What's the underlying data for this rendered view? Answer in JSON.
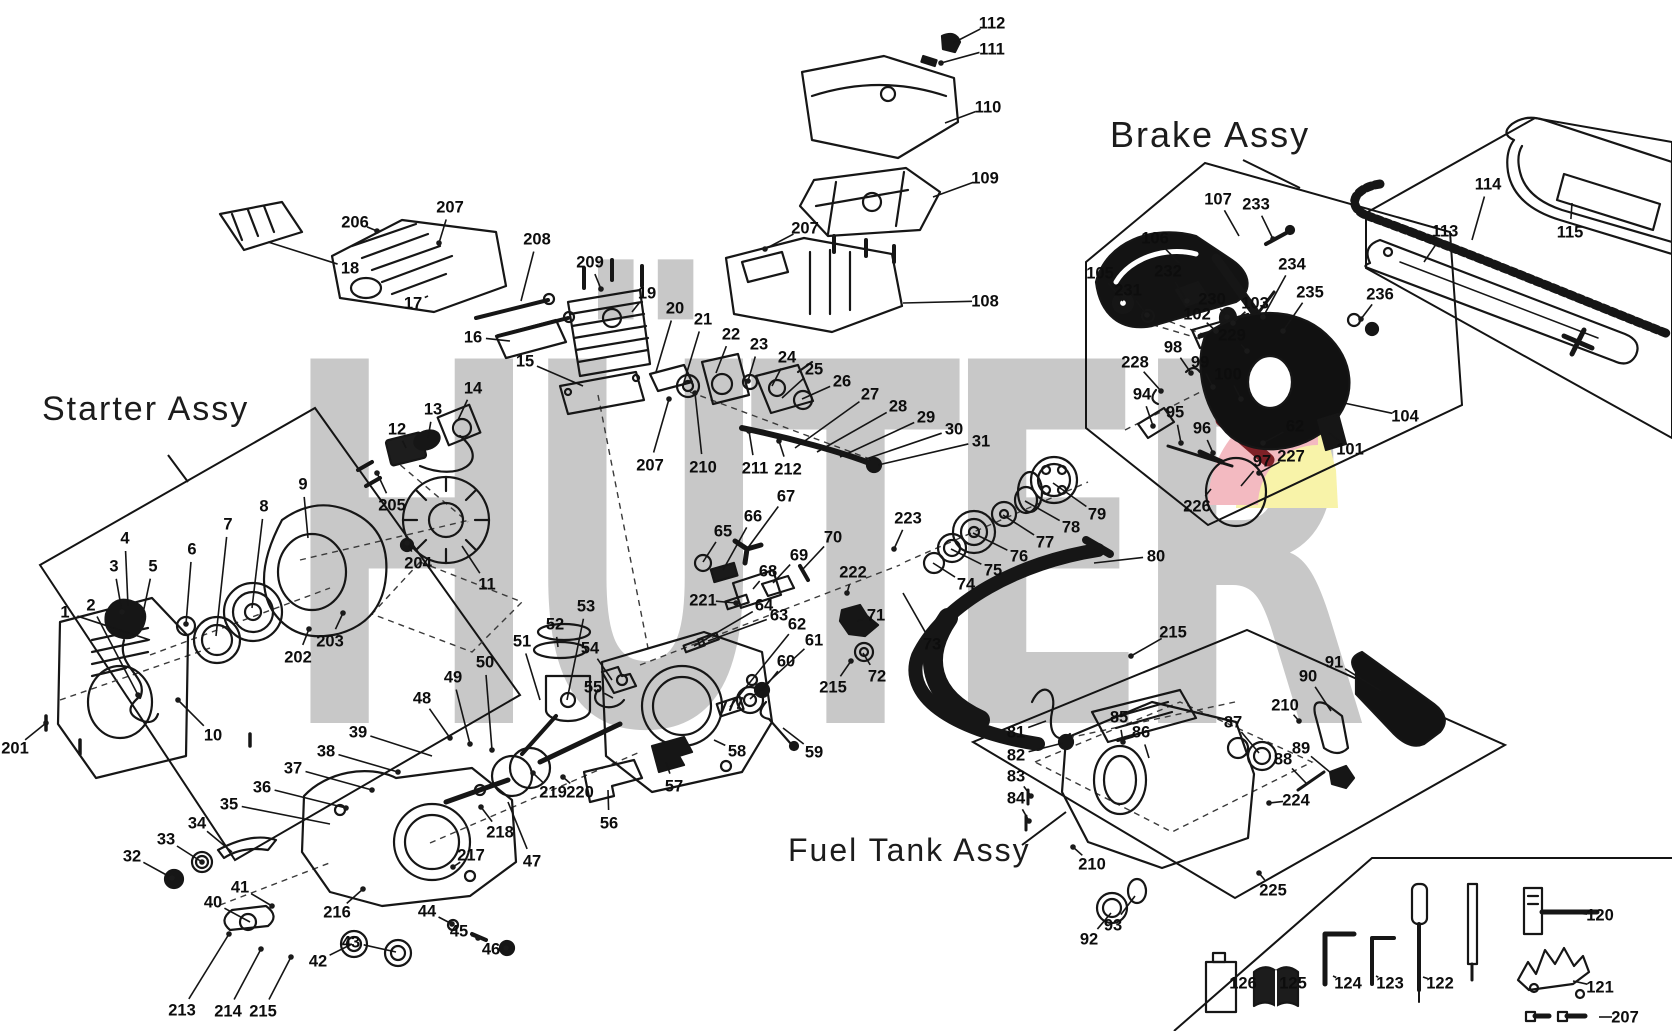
{
  "watermark": {
    "text": "HÜTER",
    "color": "#c8c8c8",
    "accent_pink": "#f3bac1",
    "accent_red": "#7e2127",
    "accent_yellow": "#f8f3a9"
  },
  "assembly_labels": [
    {
      "text": "Starter Assy",
      "x": 42,
      "y": 390,
      "fs": 34
    },
    {
      "text": "Brake Assy",
      "x": 1110,
      "y": 114,
      "fs": 36
    },
    {
      "text": "Fuel Tank Assy",
      "x": 788,
      "y": 832,
      "fs": 32
    }
  ],
  "parts": [
    {
      "n": "1",
      "x": 65,
      "y": 612,
      "tx": 150,
      "ty": 640
    },
    {
      "n": "2",
      "x": 91,
      "y": 605,
      "tx": 138,
      "ty": 695,
      "d": 1
    },
    {
      "n": "3",
      "x": 114,
      "y": 566,
      "tx": 122,
      "ty": 612,
      "d": 1
    },
    {
      "n": "4",
      "x": 125,
      "y": 538,
      "tx": 128,
      "ty": 606
    },
    {
      "n": "5",
      "x": 153,
      "y": 566,
      "tx": 142,
      "ty": 618
    },
    {
      "n": "6",
      "x": 192,
      "y": 549,
      "tx": 186,
      "ty": 624,
      "d": 1
    },
    {
      "n": "7",
      "x": 228,
      "y": 524,
      "tx": 216,
      "ty": 636
    },
    {
      "n": "8",
      "x": 264,
      "y": 506,
      "tx": 252,
      "ty": 608
    },
    {
      "n": "9",
      "x": 303,
      "y": 484,
      "tx": 308,
      "ty": 538
    },
    {
      "n": "10",
      "x": 213,
      "y": 735,
      "tx": 178,
      "ty": 700,
      "d": 1
    },
    {
      "n": "11",
      "x": 487,
      "y": 584,
      "tx": 462,
      "ty": 546
    },
    {
      "n": "12",
      "x": 397,
      "y": 429,
      "tx": 406,
      "ty": 448
    },
    {
      "n": "13",
      "x": 433,
      "y": 409,
      "tx": 428,
      "ty": 438
    },
    {
      "n": "14",
      "x": 473,
      "y": 388,
      "tx": 458,
      "ty": 420
    },
    {
      "n": "15",
      "x": 525,
      "y": 361,
      "tx": 583,
      "ty": 386
    },
    {
      "n": "16",
      "x": 473,
      "y": 337,
      "tx": 510,
      "ty": 341
    },
    {
      "n": "17",
      "x": 413,
      "y": 303,
      "tx": 428,
      "ty": 296
    },
    {
      "n": "18",
      "x": 350,
      "y": 268,
      "tx": 268,
      "ty": 242
    },
    {
      "n": "19",
      "x": 647,
      "y": 293,
      "tx": 632,
      "ty": 312
    },
    {
      "n": "20",
      "x": 675,
      "y": 308,
      "tx": 656,
      "ty": 372
    },
    {
      "n": "21",
      "x": 703,
      "y": 319,
      "tx": 684,
      "ty": 382
    },
    {
      "n": "22",
      "x": 731,
      "y": 334,
      "tx": 716,
      "ty": 373
    },
    {
      "n": "23",
      "x": 759,
      "y": 344,
      "tx": 748,
      "ty": 381,
      "d": 1
    },
    {
      "n": "24",
      "x": 787,
      "y": 357,
      "tx": 772,
      "ty": 386
    },
    {
      "n": "25",
      "x": 814,
      "y": 369,
      "tx": 782,
      "ty": 398
    },
    {
      "n": "26",
      "x": 842,
      "y": 381,
      "tx": 802,
      "ty": 399
    },
    {
      "n": "27",
      "x": 870,
      "y": 394,
      "tx": 795,
      "ty": 448
    },
    {
      "n": "28",
      "x": 898,
      "y": 406,
      "tx": 817,
      "ty": 452
    },
    {
      "n": "29",
      "x": 926,
      "y": 417,
      "tx": 840,
      "ty": 457
    },
    {
      "n": "30",
      "x": 954,
      "y": 429,
      "tx": 860,
      "ty": 461
    },
    {
      "n": "31",
      "x": 981,
      "y": 441,
      "tx": 878,
      "ty": 465
    },
    {
      "n": "32",
      "x": 132,
      "y": 856,
      "tx": 172,
      "ty": 878,
      "d": 1
    },
    {
      "n": "33",
      "x": 166,
      "y": 839,
      "tx": 202,
      "ty": 862,
      "d": 1
    },
    {
      "n": "34",
      "x": 197,
      "y": 823,
      "tx": 232,
      "ty": 852
    },
    {
      "n": "35",
      "x": 229,
      "y": 804,
      "tx": 330,
      "ty": 824
    },
    {
      "n": "36",
      "x": 262,
      "y": 787,
      "tx": 346,
      "ty": 808,
      "d": 1
    },
    {
      "n": "37",
      "x": 293,
      "y": 768,
      "tx": 372,
      "ty": 790,
      "d": 1
    },
    {
      "n": "38",
      "x": 326,
      "y": 751,
      "tx": 398,
      "ty": 772,
      "d": 1
    },
    {
      "n": "39",
      "x": 358,
      "y": 732,
      "tx": 432,
      "ty": 756
    },
    {
      "n": "40",
      "x": 213,
      "y": 902,
      "tx": 250,
      "ty": 922
    },
    {
      "n": "41",
      "x": 240,
      "y": 887,
      "tx": 272,
      "ty": 906,
      "d": 1
    },
    {
      "n": "42",
      "x": 318,
      "y": 961,
      "tx": 352,
      "ty": 944
    },
    {
      "n": "43",
      "x": 351,
      "y": 942,
      "tx": 396,
      "ty": 952
    },
    {
      "n": "44",
      "x": 427,
      "y": 911,
      "tx": 452,
      "ty": 924,
      "d": 1
    },
    {
      "n": "45",
      "x": 459,
      "y": 931,
      "tx": 478,
      "ty": 938,
      "d": 1
    },
    {
      "n": "46",
      "x": 491,
      "y": 949,
      "tx": 506,
      "ty": 948,
      "d": 1
    },
    {
      "n": "47",
      "x": 532,
      "y": 861,
      "tx": 508,
      "ty": 802
    },
    {
      "n": "48",
      "x": 422,
      "y": 698,
      "tx": 450,
      "ty": 738,
      "d": 1
    },
    {
      "n": "49",
      "x": 453,
      "y": 677,
      "tx": 470,
      "ty": 744,
      "d": 1
    },
    {
      "n": "50",
      "x": 485,
      "y": 662,
      "tx": 492,
      "ty": 750,
      "d": 1
    },
    {
      "n": "51",
      "x": 522,
      "y": 641,
      "tx": 540,
      "ty": 700
    },
    {
      "n": "52",
      "x": 555,
      "y": 624,
      "tx": 558,
      "ty": 647
    },
    {
      "n": "53",
      "x": 586,
      "y": 606,
      "tx": 567,
      "ty": 700
    },
    {
      "n": "54",
      "x": 590,
      "y": 648,
      "tx": 612,
      "ty": 680
    },
    {
      "n": "55",
      "x": 593,
      "y": 687,
      "tx": 613,
      "ty": 698
    },
    {
      "n": "56",
      "x": 609,
      "y": 823,
      "tx": 608,
      "ty": 790
    },
    {
      "n": "57",
      "x": 674,
      "y": 786,
      "tx": 666,
      "ty": 762
    },
    {
      "n": "58",
      "x": 737,
      "y": 751,
      "tx": 714,
      "ty": 740
    },
    {
      "n": "59",
      "x": 814,
      "y": 752,
      "tx": 783,
      "ty": 728
    },
    {
      "n": "60",
      "x": 786,
      "y": 661,
      "tx": 762,
      "ty": 691
    },
    {
      "n": "61",
      "x": 814,
      "y": 640,
      "tx": 750,
      "ty": 699
    },
    {
      "n": "62",
      "x": 797,
      "y": 624,
      "tx": 730,
      "ty": 707
    },
    {
      "n": "63",
      "x": 779,
      "y": 615,
      "tx": 708,
      "ty": 641
    },
    {
      "n": "64",
      "x": 764,
      "y": 605,
      "tx": 694,
      "ty": 646
    },
    {
      "n": "65",
      "x": 723,
      "y": 531,
      "tx": 703,
      "ty": 562
    },
    {
      "n": "66",
      "x": 753,
      "y": 516,
      "tx": 723,
      "ty": 570
    },
    {
      "n": "67",
      "x": 786,
      "y": 496,
      "tx": 747,
      "ty": 549
    },
    {
      "n": "68",
      "x": 768,
      "y": 571,
      "tx": 753,
      "ty": 589
    },
    {
      "n": "69",
      "x": 799,
      "y": 555,
      "tx": 773,
      "ty": 583
    },
    {
      "n": "70",
      "x": 833,
      "y": 537,
      "tx": 803,
      "ty": 569
    },
    {
      "n": "71",
      "x": 876,
      "y": 615,
      "tx": 857,
      "ty": 621
    },
    {
      "n": "72",
      "x": 877,
      "y": 676,
      "tx": 863,
      "ty": 653
    },
    {
      "n": "73",
      "x": 932,
      "y": 644,
      "tx": 903,
      "ty": 593
    },
    {
      "n": "74",
      "x": 966,
      "y": 584,
      "tx": 933,
      "ty": 563
    },
    {
      "n": "75",
      "x": 993,
      "y": 570,
      "tx": 951,
      "ty": 549
    },
    {
      "n": "76",
      "x": 1019,
      "y": 556,
      "tx": 973,
      "ty": 533
    },
    {
      "n": "77",
      "x": 1045,
      "y": 542,
      "tx": 1003,
      "ty": 515
    },
    {
      "n": "78",
      "x": 1071,
      "y": 527,
      "tx": 1025,
      "ty": 501
    },
    {
      "n": "79",
      "x": 1097,
      "y": 514,
      "tx": 1053,
      "ty": 483
    },
    {
      "n": "80",
      "x": 1156,
      "y": 556,
      "tx": 1094,
      "ty": 563
    },
    {
      "n": "81",
      "x": 1016,
      "y": 732,
      "tx": 1046,
      "ty": 721
    },
    {
      "n": "82",
      "x": 1016,
      "y": 755,
      "tx": 1063,
      "ty": 743
    },
    {
      "n": "83",
      "x": 1016,
      "y": 776,
      "tx": 1031,
      "ty": 796,
      "d": 1
    },
    {
      "n": "84",
      "x": 1016,
      "y": 798,
      "tx": 1029,
      "ty": 821,
      "d": 1
    },
    {
      "n": "85",
      "x": 1119,
      "y": 717,
      "tx": 1123,
      "ty": 742,
      "d": 1
    },
    {
      "n": "86",
      "x": 1141,
      "y": 732,
      "tx": 1149,
      "ty": 758
    },
    {
      "n": "87",
      "x": 1233,
      "y": 722,
      "tx": 1259,
      "ty": 753
    },
    {
      "n": "88",
      "x": 1283,
      "y": 759,
      "tx": 1306,
      "ty": 783
    },
    {
      "n": "89",
      "x": 1301,
      "y": 748,
      "tx": 1331,
      "ty": 773
    },
    {
      "n": "90",
      "x": 1308,
      "y": 676,
      "tx": 1331,
      "ty": 711
    },
    {
      "n": "91",
      "x": 1334,
      "y": 662,
      "tx": 1381,
      "ty": 691
    },
    {
      "n": "92",
      "x": 1089,
      "y": 939,
      "tx": 1111,
      "ty": 913
    },
    {
      "n": "93",
      "x": 1113,
      "y": 925,
      "tx": 1135,
      "ty": 896
    },
    {
      "n": "94",
      "x": 1142,
      "y": 394,
      "tx": 1153,
      "ty": 426,
      "d": 1
    },
    {
      "n": "95",
      "x": 1175,
      "y": 412,
      "tx": 1181,
      "ty": 443,
      "d": 1
    },
    {
      "n": "96",
      "x": 1202,
      "y": 428,
      "tx": 1213,
      "ty": 453,
      "d": 1
    },
    {
      "n": "97",
      "x": 1262,
      "y": 461,
      "tx": 1241,
      "ty": 486
    },
    {
      "n": "98",
      "x": 1173,
      "y": 347,
      "tx": 1191,
      "ty": 373,
      "d": 1
    },
    {
      "n": "99",
      "x": 1200,
      "y": 362,
      "tx": 1213,
      "ty": 387,
      "d": 1
    },
    {
      "n": "100",
      "x": 1228,
      "y": 374,
      "tx": 1241,
      "ty": 399,
      "d": 1
    },
    {
      "n": "101",
      "x": 1350,
      "y": 449,
      "tx": 1329,
      "ty": 433
    },
    {
      "n": "102",
      "x": 1197,
      "y": 314,
      "tx": 1216,
      "ty": 331,
      "d": 1
    },
    {
      "n": "103",
      "x": 1255,
      "y": 303,
      "tx": 1233,
      "ty": 323,
      "d": 1
    },
    {
      "n": "104",
      "x": 1405,
      "y": 416,
      "tx": 1344,
      "ty": 403
    },
    {
      "n": "105",
      "x": 1100,
      "y": 273,
      "tx": 1123,
      "ty": 301
    },
    {
      "n": "106",
      "x": 1155,
      "y": 238,
      "tx": 1179,
      "ty": 263
    },
    {
      "n": "107",
      "x": 1218,
      "y": 199,
      "tx": 1239,
      "ty": 236
    },
    {
      "n": "108",
      "x": 985,
      "y": 301,
      "tx": 903,
      "ty": 303
    },
    {
      "n": "109",
      "x": 985,
      "y": 178,
      "tx": 933,
      "ty": 197
    },
    {
      "n": "110",
      "x": 988,
      "y": 107,
      "tx": 945,
      "ty": 123
    },
    {
      "n": "111",
      "x": 992,
      "y": 49,
      "tx": 941,
      "ty": 63,
      "d": 1
    },
    {
      "n": "112",
      "x": 992,
      "y": 23,
      "tx": 953,
      "ty": 43
    },
    {
      "n": "113",
      "x": 1445,
      "y": 231,
      "tx": 1424,
      "ty": 262
    },
    {
      "n": "114",
      "x": 1488,
      "y": 184,
      "tx": 1472,
      "ty": 240
    },
    {
      "n": "115",
      "x": 1570,
      "y": 232,
      "tx": 1572,
      "ty": 203
    },
    {
      "n": "120",
      "x": 1600,
      "y": 915,
      "tx": 1573,
      "ty": 913
    },
    {
      "n": "121",
      "x": 1600,
      "y": 987,
      "tx": 1573,
      "ty": 981
    },
    {
      "n": "122",
      "x": 1440,
      "y": 983,
      "tx": 1423,
      "ty": 977
    },
    {
      "n": "123",
      "x": 1390,
      "y": 983,
      "tx": 1376,
      "ty": 976
    },
    {
      "n": "124",
      "x": 1348,
      "y": 983,
      "tx": 1333,
      "ty": 976
    },
    {
      "n": "125",
      "x": 1293,
      "y": 983,
      "tx": 1281,
      "ty": 981
    },
    {
      "n": "126",
      "x": 1243,
      "y": 983,
      "tx": 1231,
      "ty": 981
    },
    {
      "n": "201",
      "x": 15,
      "y": 748,
      "tx": 46,
      "ty": 723,
      "d": 1
    },
    {
      "n": "202",
      "x": 298,
      "y": 657,
      "tx": 309,
      "ty": 629,
      "d": 1
    },
    {
      "n": "203",
      "x": 330,
      "y": 641,
      "tx": 343,
      "ty": 613,
      "d": 1
    },
    {
      "n": "204",
      "x": 418,
      "y": 563,
      "tx": 407,
      "ty": 543,
      "d": 1
    },
    {
      "n": "205",
      "x": 392,
      "y": 505,
      "tx": 377,
      "ty": 473,
      "d": 1
    },
    {
      "n": "206",
      "x": 355,
      "y": 222,
      "tx": 377,
      "ty": 231,
      "d": 1
    },
    {
      "n": "207",
      "x": 450,
      "y": 207,
      "tx": 439,
      "ty": 243,
      "d": 1
    },
    {
      "n": "207",
      "x": 805,
      "y": 228,
      "tx": 765,
      "ty": 249,
      "d": 1
    },
    {
      "n": "207",
      "x": 650,
      "y": 465,
      "tx": 669,
      "ty": 399,
      "d": 1
    },
    {
      "n": "207",
      "x": 1625,
      "y": 1017,
      "tx": 1599,
      "ty": 1017
    },
    {
      "n": "208",
      "x": 537,
      "y": 239,
      "tx": 521,
      "ty": 301
    },
    {
      "n": "209",
      "x": 590,
      "y": 262,
      "tx": 601,
      "ty": 289,
      "d": 1
    },
    {
      "n": "210",
      "x": 703,
      "y": 467,
      "tx": 695,
      "ty": 393,
      "d": 1
    },
    {
      "n": "210",
      "x": 1285,
      "y": 705,
      "tx": 1299,
      "ty": 721,
      "d": 1
    },
    {
      "n": "210",
      "x": 1092,
      "y": 864,
      "tx": 1073,
      "ty": 847,
      "d": 1
    },
    {
      "n": "211",
      "x": 755,
      "y": 468,
      "tx": 749,
      "ty": 431,
      "d": 1
    },
    {
      "n": "212",
      "x": 788,
      "y": 469,
      "tx": 779,
      "ty": 441,
      "d": 1
    },
    {
      "n": "213",
      "x": 182,
      "y": 1010,
      "tx": 229,
      "ty": 934,
      "d": 1
    },
    {
      "n": "214",
      "x": 228,
      "y": 1011,
      "tx": 261,
      "ty": 949,
      "d": 1
    },
    {
      "n": "215",
      "x": 263,
      "y": 1011,
      "tx": 291,
      "ty": 957,
      "d": 1
    },
    {
      "n": "215",
      "x": 833,
      "y": 687,
      "tx": 851,
      "ty": 661,
      "d": 1
    },
    {
      "n": "215",
      "x": 1173,
      "y": 632,
      "tx": 1131,
      "ty": 656,
      "d": 1
    },
    {
      "n": "216",
      "x": 337,
      "y": 912,
      "tx": 363,
      "ty": 889,
      "d": 1
    },
    {
      "n": "217",
      "x": 471,
      "y": 855,
      "tx": 453,
      "ty": 867,
      "d": 1
    },
    {
      "n": "218",
      "x": 500,
      "y": 832,
      "tx": 481,
      "ty": 807,
      "d": 1
    },
    {
      "n": "219",
      "x": 553,
      "y": 792,
      "tx": 533,
      "ty": 773,
      "d": 1
    },
    {
      "n": "220",
      "x": 580,
      "y": 792,
      "tx": 563,
      "ty": 777,
      "d": 1
    },
    {
      "n": "221",
      "x": 703,
      "y": 600,
      "tx": 736,
      "ty": 603,
      "d": 1
    },
    {
      "n": "222",
      "x": 853,
      "y": 572,
      "tx": 847,
      "ty": 593,
      "d": 1
    },
    {
      "n": "223",
      "x": 908,
      "y": 518,
      "tx": 894,
      "ty": 549,
      "d": 1
    },
    {
      "n": "224",
      "x": 1296,
      "y": 800,
      "tx": 1269,
      "ty": 803,
      "d": 1
    },
    {
      "n": "225",
      "x": 1273,
      "y": 890,
      "tx": 1259,
      "ty": 873,
      "d": 1
    },
    {
      "n": "226",
      "x": 1197,
      "y": 506,
      "tx": 1211,
      "ty": 489
    },
    {
      "n": "227",
      "x": 1291,
      "y": 456,
      "tx": 1259,
      "ty": 473,
      "d": 1
    },
    {
      "n": "228",
      "x": 1135,
      "y": 362,
      "tx": 1161,
      "ty": 391,
      "d": 1
    },
    {
      "n": "229",
      "x": 1232,
      "y": 335,
      "tx": 1247,
      "ty": 351,
      "d": 1
    },
    {
      "n": "230",
      "x": 1212,
      "y": 299,
      "tx": 1227,
      "ty": 317,
      "d": 1
    },
    {
      "n": "231",
      "x": 1128,
      "y": 290,
      "tx": 1147,
      "ty": 315,
      "d": 1
    },
    {
      "n": "232",
      "x": 1168,
      "y": 271,
      "tx": 1187,
      "ty": 301,
      "d": 1
    },
    {
      "n": "233",
      "x": 1256,
      "y": 204,
      "tx": 1273,
      "ty": 239,
      "d": 1
    },
    {
      "n": "234",
      "x": 1292,
      "y": 264,
      "tx": 1263,
      "ty": 317,
      "d": 1
    },
    {
      "n": "235",
      "x": 1310,
      "y": 292,
      "tx": 1283,
      "ty": 331,
      "d": 1
    },
    {
      "n": "236",
      "x": 1380,
      "y": 294,
      "tx": 1361,
      "ty": 319,
      "d": 1
    },
    {
      "n": "62",
      "x": 1295,
      "y": 426,
      "tx": 1263,
      "ty": 443,
      "d": 1
    }
  ]
}
